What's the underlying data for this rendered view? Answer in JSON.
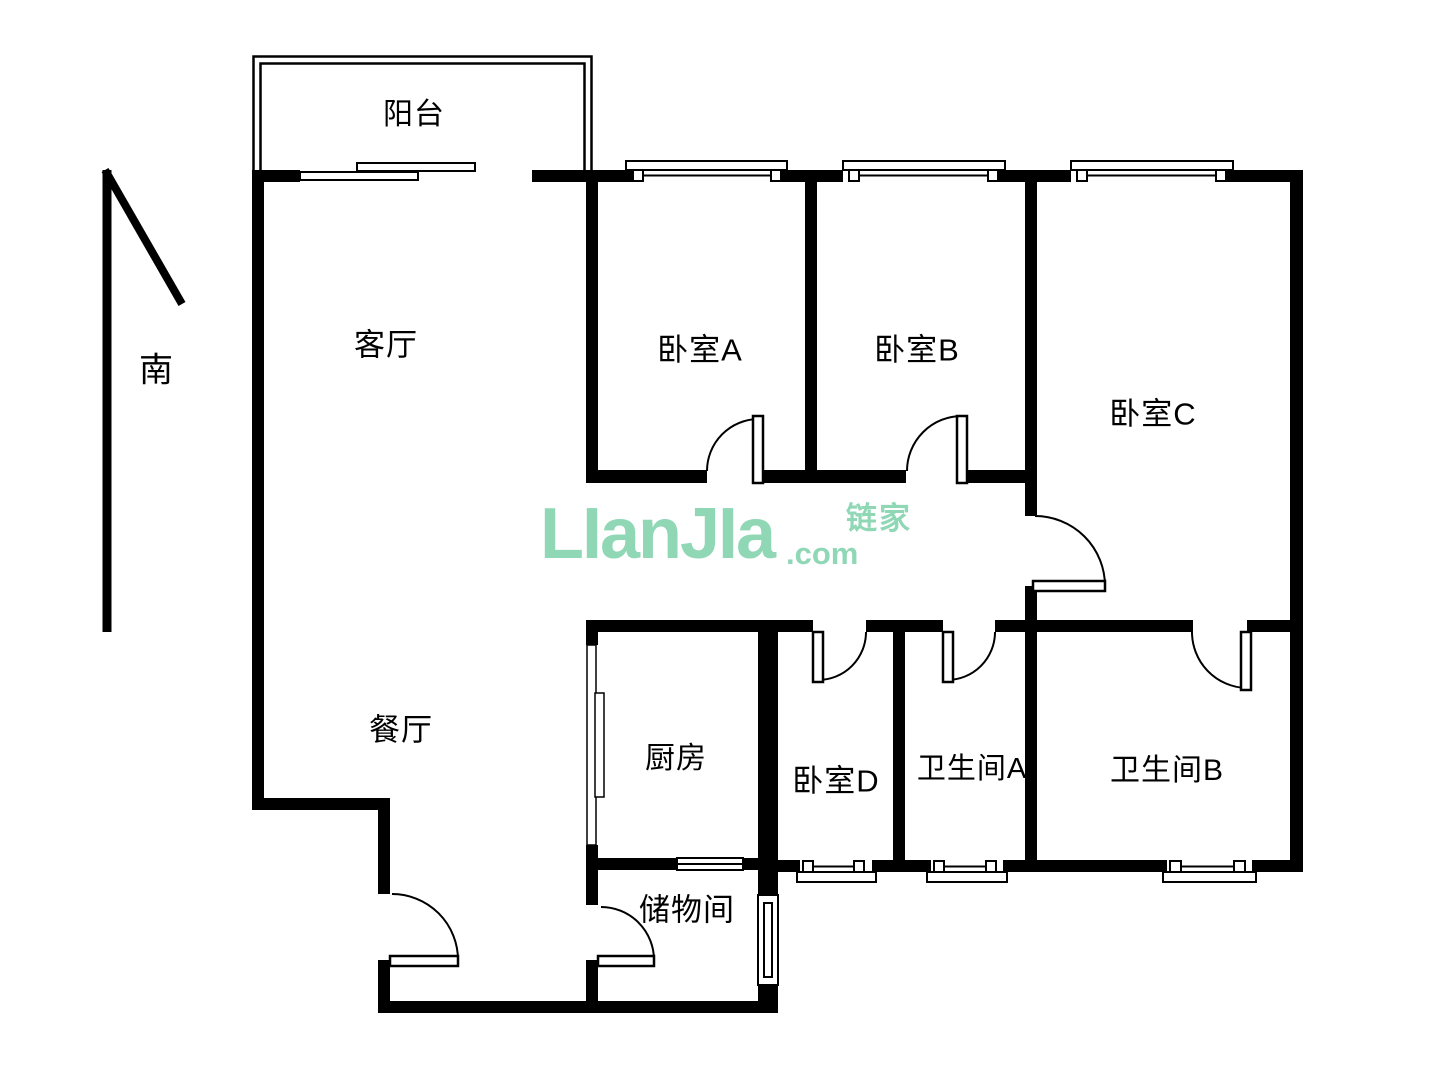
{
  "page": {
    "type": "floor-plan",
    "background": "#ffffff",
    "wall_color": "#000000"
  },
  "compass": {
    "label": "南"
  },
  "rooms": [
    {
      "id": "balcony",
      "label": "阳台"
    },
    {
      "id": "living-room",
      "label": "客厅"
    },
    {
      "id": "bedroom-a",
      "label": "卧室A"
    },
    {
      "id": "bedroom-b",
      "label": "卧室B"
    },
    {
      "id": "bedroom-c",
      "label": "卧室C"
    },
    {
      "id": "dining-room",
      "label": "餐厅"
    },
    {
      "id": "kitchen",
      "label": "厨房"
    },
    {
      "id": "bedroom-d",
      "label": "卧室D"
    },
    {
      "id": "bathroom-a",
      "label": "卫生间A"
    },
    {
      "id": "bathroom-b",
      "label": "卫生间B"
    },
    {
      "id": "storage-room",
      "label": "储物间"
    }
  ],
  "watermark": {
    "logo": "LIanJIa",
    "brand_cn": "链家",
    "suffix": ".com",
    "color": "#90d7b6"
  }
}
